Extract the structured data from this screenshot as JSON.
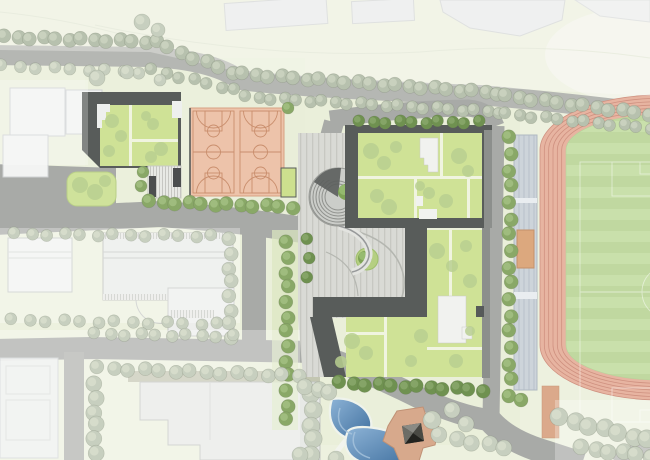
{
  "meta": {
    "title": "Campus master plan — site plan rendering with running track, basketball courts, green-roof school buildings and pond",
    "canvas": {
      "w": 650,
      "h": 460
    }
  },
  "palette": {
    "bg": "#edf1df",
    "bgTint": "#e8eed6",
    "road": "#a8aaa7",
    "roadFaded": "#b5b7b3",
    "ctxBldg": "#e9ebec",
    "ctxStroke": "#cfd2d3",
    "whiteBldg": "#f2f3f2",
    "dark": "#585c5a",
    "darkLight": "#8c8f8c",
    "greenRoof": "#cfe296",
    "roofPath": "#f0f4e0",
    "roofTree": "#b8cf90",
    "court": "#edc3aa",
    "courtLine": "#c98e6d",
    "track": "#e7b4a1",
    "trackLine": "#cf9180",
    "infield": "#c9e0ab",
    "infieldStripe": "#c0d8a0",
    "fieldLine": "#ffffff",
    "stand": "#cdd4da",
    "standLine": "#b0b9c2",
    "standOrange": "#dca87e",
    "runway": "#dba98b",
    "plaza": "#d9dad5",
    "plazaLine": "#c7c8c2",
    "water1": "#85aed3",
    "water2": "#3f6f9e",
    "shore": "#eff3ec",
    "pavilion": "#d7a98c",
    "pavilionDark": "#3e3e3c",
    "gym": "#e9ebe8",
    "gymStroke": "#b8bbb8",
    "planter": "#b5cf82",
    "planterTree": "#7ea356",
    "planterTreeIn": "#97bb70",
    "treeStreetA": "#b7c1ae",
    "treeStreetB": "#cbd3c0",
    "treeSiteA": "#89a867",
    "treeSiteB": "#a2be81",
    "treeDarkA": "#6f9150",
    "treeDarkB": "#87a669",
    "treeFadeA": "#c7cfbf",
    "treeFadeB": "#d7ddcc"
  },
  "site": {
    "running_track": {
      "lanes": 6,
      "lane_band_px": 26,
      "infield": "soccer-field"
    },
    "basketball_courts": {
      "count": 2
    },
    "grandstand": {
      "orange_blocks": 1
    },
    "green_roof_buildings": 3,
    "pond_pools": 2,
    "pavilion": 1,
    "spiral_ramp": 1,
    "plaza_planters": 2
  },
  "vegetation": {
    "rows": [
      [
        5,
        37,
        158,
        42,
        13,
        7,
        "street"
      ],
      [
        168,
        48,
        232,
        72,
        6,
        7,
        "street"
      ],
      [
        243,
        74,
        498,
        93,
        21,
        7,
        "street"
      ],
      [
        506,
        96,
        648,
        114,
        12,
        7,
        "street"
      ],
      [
        152,
        70,
        235,
        90,
        7,
        6,
        "street"
      ],
      [
        246,
        97,
        500,
        112,
        21,
        6,
        "street"
      ],
      [
        506,
        114,
        650,
        128,
        12,
        6,
        "street"
      ],
      [
        2,
        66,
        140,
        72,
        9,
        6,
        "fade"
      ],
      [
        150,
        202,
        292,
        207,
        12,
        7,
        "site"
      ],
      [
        360,
        122,
        478,
        122,
        10,
        6,
        "dark"
      ],
      [
        510,
        138,
        510,
        396,
        17,
        7,
        "site"
      ],
      [
        287,
        243,
        287,
        420,
        13,
        7,
        "site"
      ],
      [
        308,
        240,
        308,
        276,
        3,
        6,
        "dark"
      ],
      [
        340,
        383,
        482,
        390,
        12,
        7,
        "dark"
      ],
      [
        230,
        240,
        230,
        338,
        8,
        7,
        "fade"
      ],
      [
        15,
        234,
        212,
        236,
        13,
        6,
        "fade"
      ],
      [
        12,
        320,
        218,
        324,
        13,
        6,
        "fade"
      ],
      [
        98,
        368,
        298,
        376,
        14,
        7,
        "fade"
      ],
      [
        95,
        334,
        232,
        336,
        10,
        6,
        "fade"
      ],
      [
        95,
        385,
        95,
        452,
        6,
        8,
        "fade"
      ],
      [
        312,
        395,
        312,
        455,
        5,
        9,
        "fade"
      ],
      [
        306,
        388,
        330,
        391,
        3,
        8,
        "fade"
      ],
      [
        440,
        436,
        505,
        448,
        5,
        8,
        "fade"
      ],
      [
        560,
        418,
        648,
        440,
        7,
        9,
        "fade"
      ],
      [
        582,
        448,
        650,
        456,
        6,
        8,
        "fade"
      ]
    ],
    "singles": [
      [
        142,
        22,
        8,
        "fade"
      ],
      [
        158,
        30,
        7,
        "fade"
      ],
      [
        97,
        78,
        8,
        "fade"
      ],
      [
        127,
        72,
        7,
        "fade"
      ],
      [
        160,
        80,
        6,
        "fade"
      ],
      [
        143,
        172,
        6,
        "site"
      ],
      [
        141,
        186,
        6,
        "site"
      ],
      [
        288,
        108,
        6,
        "site"
      ],
      [
        432,
        420,
        9,
        "fade"
      ],
      [
        452,
        410,
        8,
        "fade"
      ],
      [
        466,
        424,
        8,
        "fade"
      ],
      [
        300,
        455,
        8,
        "fade"
      ],
      [
        336,
        459,
        8,
        "fade"
      ],
      [
        521,
        400,
        7,
        "site"
      ]
    ],
    "roof_trees": [
      [
        371,
        151,
        8
      ],
      [
        384,
        163,
        7
      ],
      [
        396,
        147,
        6
      ],
      [
        459,
        156,
        8
      ],
      [
        468,
        171,
        6
      ],
      [
        377,
        196,
        7
      ],
      [
        389,
        207,
        8
      ],
      [
        429,
        193,
        6
      ],
      [
        446,
        201,
        7
      ],
      [
        420,
        186,
        5
      ],
      [
        437,
        251,
        8
      ],
      [
        452,
        266,
        6
      ],
      [
        466,
        246,
        6
      ],
      [
        470,
        281,
        7
      ],
      [
        352,
        341,
        8
      ],
      [
        366,
        353,
        7
      ],
      [
        341,
        362,
        6
      ],
      [
        421,
        336,
        7
      ],
      [
        411,
        361,
        6
      ],
      [
        456,
        361,
        7
      ],
      [
        470,
        331,
        5
      ],
      [
        112,
        121,
        7
      ],
      [
        121,
        136,
        6
      ],
      [
        109,
        151,
        6
      ],
      [
        146,
        116,
        5
      ],
      [
        153,
        124,
        6
      ],
      [
        161,
        149,
        7
      ],
      [
        151,
        157,
        6
      ],
      [
        80,
        185,
        8
      ],
      [
        95,
        192,
        8
      ],
      [
        105,
        181,
        6
      ]
    ]
  }
}
